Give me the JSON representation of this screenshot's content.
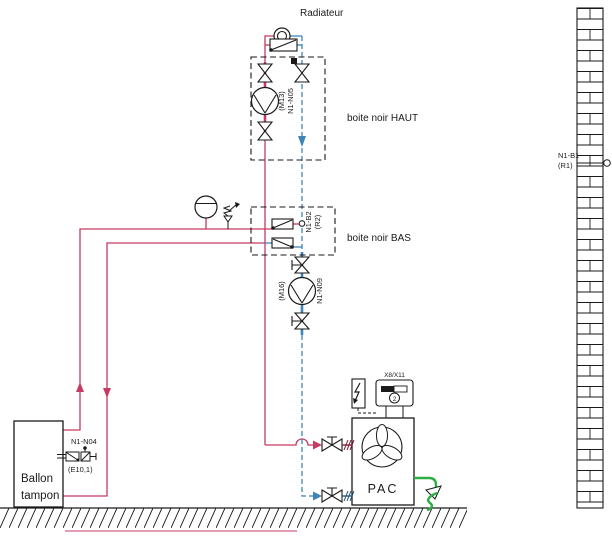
{
  "colors": {
    "pipe_hot": "#c73a62",
    "pipe_cold": "#3d85b8",
    "drain_green": "#2fae44",
    "line_black": "#1a1a1a"
  },
  "labels": {
    "radiator": "Radiateur",
    "box_top": "boite noir HAUT",
    "box_bottom": "boite noir BAS",
    "tank_line1": "Ballon",
    "tank_line2": "tampon",
    "heat_pump": "PAC"
  },
  "tags": {
    "pump_top_motor": "(M13)",
    "pump_top_id": "N1-N05",
    "pump_bottom_motor": "(M16)",
    "pump_bottom_id": "N1-N09",
    "sensor_mid_id": "N1-B2",
    "sensor_mid_ref": "(R2)",
    "sensor_outdoor_id": "N1-B1",
    "sensor_outdoor_ref": "(R1)",
    "sensor_tank_id": "N1-N04",
    "sensor_tank_ref": "(E10,1)",
    "controller_id": "X8/X11",
    "controller_num": "2"
  }
}
